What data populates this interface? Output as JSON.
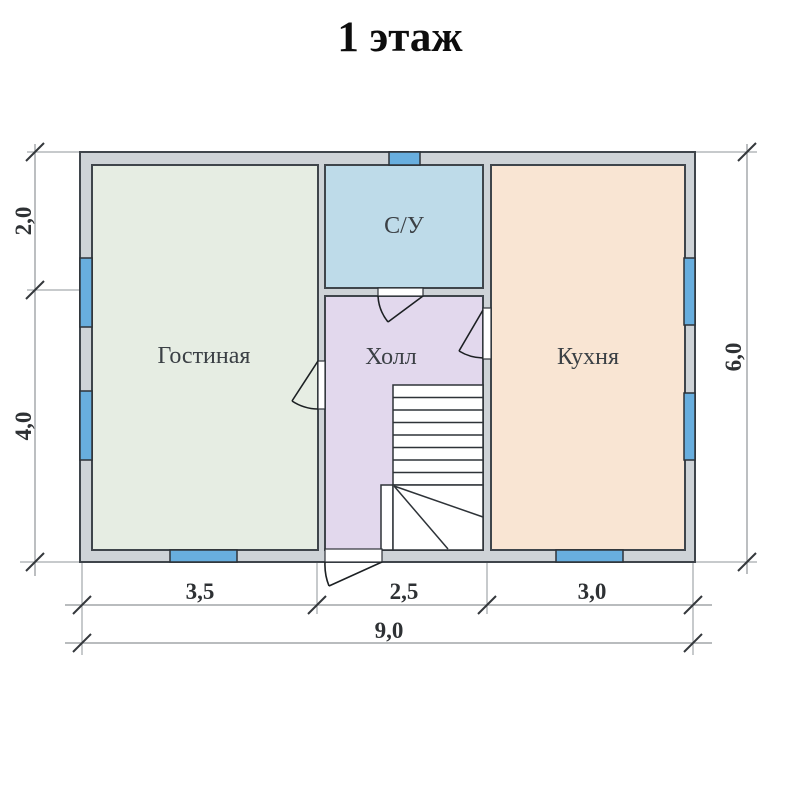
{
  "title": "1 этаж",
  "plan": {
    "rooms": [
      {
        "name": "Гостиная",
        "color": "#e6ede3"
      },
      {
        "name": "С/У",
        "color": "#bedbe9"
      },
      {
        "name": "Холл",
        "color": "#e2d8ed"
      },
      {
        "name": "Кухня",
        "color": "#f9e5d3"
      }
    ],
    "dimensions": {
      "left_top": "2,0",
      "left_bottom": "4,0",
      "right": "6,0",
      "bottom_left": "3,5",
      "bottom_middle": "2,5",
      "bottom_right": "3,0",
      "bottom_total": "9,0"
    },
    "colors": {
      "wall_fill": "#ced3d7",
      "wall_outline": "#3f454b",
      "window_fill": "#68aede",
      "dimension_line": "#8f9498",
      "tick_mark": "#34383c"
    }
  }
}
